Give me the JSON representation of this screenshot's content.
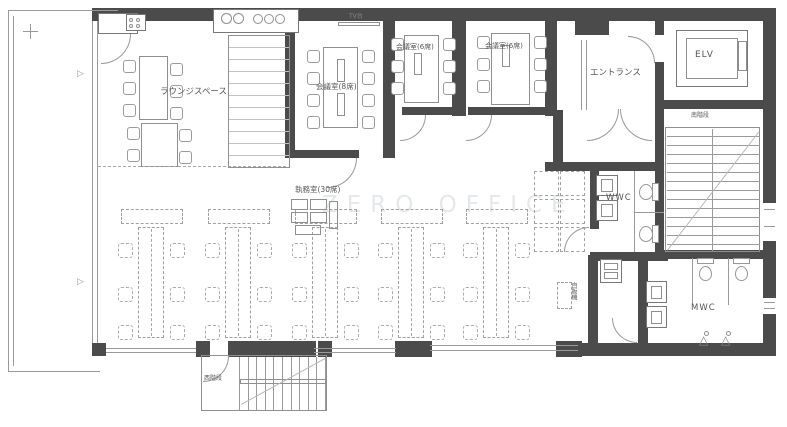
{
  "colors": {
    "wall": "#4b4b4b",
    "line": "#9a9a9a",
    "label": "#555555",
    "furniture_dashed": "#ababab"
  },
  "rooms": {
    "lounge": {
      "label": "ラウンジスペース"
    },
    "meeting_room_8": {
      "label": "会議室(8席)",
      "seats": 8
    },
    "meeting_room_6a": {
      "label": "会議室(6席)",
      "seats": 6
    },
    "meeting_room_6b": {
      "label": "会議室(6席)",
      "seats": 6
    },
    "office": {
      "label": "執務室(30席)",
      "seats": 30
    },
    "entrance": {
      "label": "エントランス"
    },
    "elevator": {
      "label": "ELV"
    },
    "south_stairs": {
      "label": "南階段"
    },
    "west_stairs": {
      "label": "西階段"
    },
    "wwc": {
      "label": "WWC"
    },
    "mwc": {
      "label": "MWC"
    }
  },
  "annotations": {
    "tv_stand": "TV台",
    "vending": "自販機",
    "watermark": "ZERO OFFICE"
  }
}
